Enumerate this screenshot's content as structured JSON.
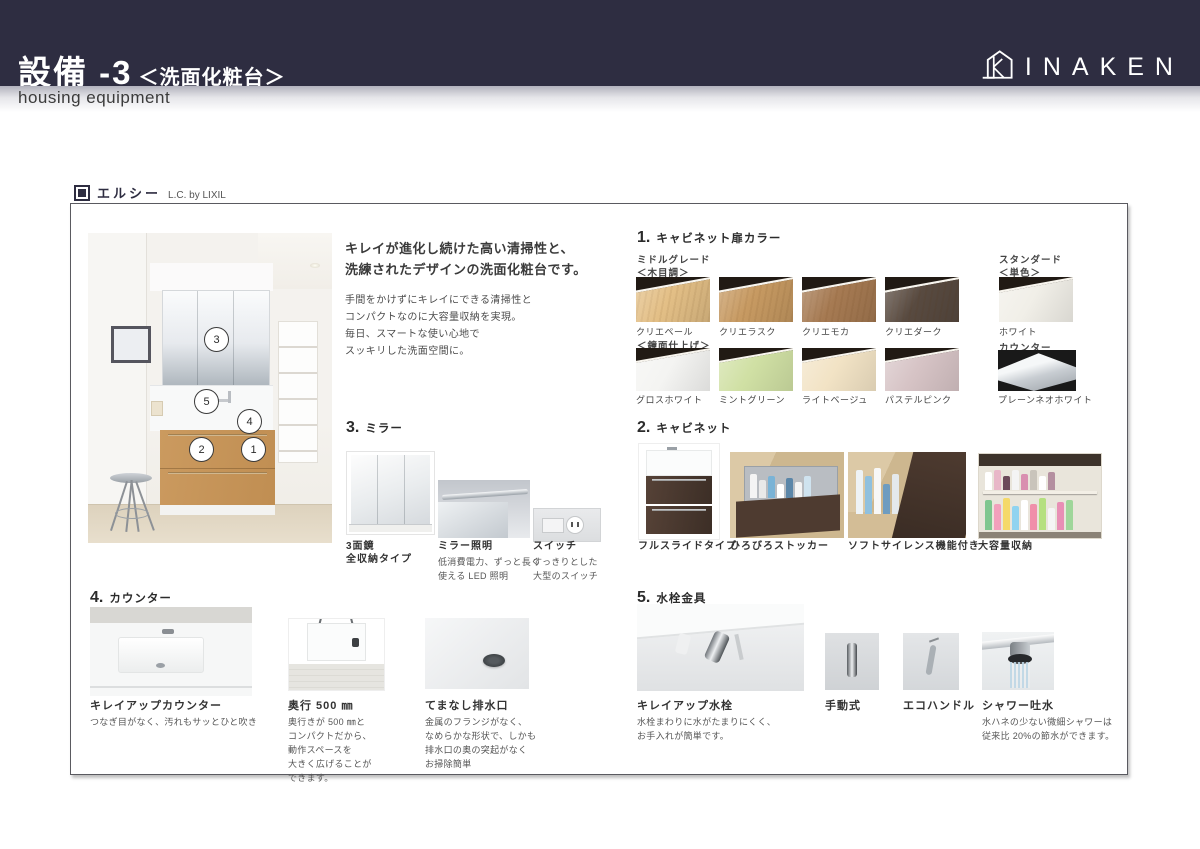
{
  "header": {
    "title_jp": "設備 -3",
    "title_sub": "＜洗面化粧台＞",
    "subtitle_en": "housing equipment",
    "brand": "INAKEN"
  },
  "product": {
    "name_jp": "エルシー",
    "name_sub": "L.C. by LIXIL"
  },
  "photo": {
    "callouts": [
      "1",
      "2",
      "3",
      "4",
      "5"
    ]
  },
  "intro": {
    "headline": [
      "キレイが進化し続けた高い清掃性と、",
      "洗練されたデザインの洗面化粧台です。"
    ],
    "body": [
      "手間をかけずにキレイにできる清掃性と",
      "コンパクトなのに大容量収納を実現。",
      "毎日、スマートな使い心地で",
      "スッキリした洗面空間に。"
    ]
  },
  "section1": {
    "no": "1.",
    "title": "キャビネット扉カラー",
    "grade_mid": "ミドルグレード",
    "grade_mid_sub": "＜木目調＞",
    "grade_std": "スタンダード",
    "grade_std_sub": "＜単色＞",
    "mirror_finish": "＜鏡面仕上げ＞",
    "counter_head": "カウンター",
    "wood": [
      {
        "label": "クリエペール",
        "color": "#e3bf86"
      },
      {
        "label": "クリエラスク",
        "color": "#c79a62"
      },
      {
        "label": "クリエモカ",
        "color": "#a67a52"
      },
      {
        "label": "クリエダーク",
        "color": "#584a40"
      }
    ],
    "std": {
      "label": "ホワイト",
      "color": "#f1efe8"
    },
    "gloss": [
      {
        "label": "グロスホワイト",
        "color": "#f4f4f2"
      },
      {
        "label": "ミントグリーン",
        "color": "#d0e0a4"
      },
      {
        "label": "ライトベージュ",
        "color": "#f2e3c5"
      },
      {
        "label": "パステルピンク",
        "color": "#d6c3c5"
      }
    ],
    "counter": {
      "label": "プレーンネオホワイト"
    }
  },
  "section2": {
    "no": "2.",
    "title": "キャビネット",
    "items": [
      {
        "label": "フルスライドタイプ"
      },
      {
        "label": "ひろびろストッカー"
      },
      {
        "label": "ソフトサイレンス機能付き"
      },
      {
        "label": "大容量収納"
      }
    ]
  },
  "section3": {
    "no": "3.",
    "title": "ミラー",
    "mirror3": {
      "label1": "3面鏡",
      "label2": "全収納タイプ"
    },
    "light": {
      "label": "ミラー照明",
      "desc": [
        "低消費電力、ずっと長く",
        "使える LED 照明"
      ]
    },
    "switch": {
      "label": "スイッチ",
      "desc": [
        "すっきりとした",
        "大型のスイッチ"
      ]
    }
  },
  "section4": {
    "no": "4.",
    "title": "カウンター",
    "items": [
      {
        "label": "キレイアップカウンター",
        "desc": [
          "つなぎ目がなく、汚れもサッとひと吹き"
        ]
      },
      {
        "label": "奥行 500 ㎜",
        "desc": [
          "奥行きが 500 ㎜と",
          "コンパクトだから、",
          "動作スペースを",
          "大きく広げることが",
          "できます。"
        ]
      },
      {
        "label": "てまなし排水口",
        "desc": [
          "金属のフランジがなく、",
          "なめらかな形状で、しかも",
          "排水口の奥の突起がなく",
          "お掃除簡単"
        ]
      }
    ]
  },
  "section5": {
    "no": "5.",
    "title": "水栓金具",
    "items": [
      {
        "label": "キレイアップ水栓",
        "desc": [
          "水栓まわりに水がたまりにくく、",
          "お手入れが簡単です。"
        ]
      },
      {
        "label": "手動式"
      },
      {
        "label": "エコハンドル"
      },
      {
        "label": "シャワー吐水",
        "desc": [
          "水ハネの少ない微細シャワーは",
          "従来比 20%の節水ができます。"
        ]
      }
    ]
  },
  "colors": {
    "header_bar": "#2e2d41",
    "drawer_wood": "#c9975c",
    "cabinet_brown": "#4a392e",
    "text_dark": "#3a3a3a"
  }
}
